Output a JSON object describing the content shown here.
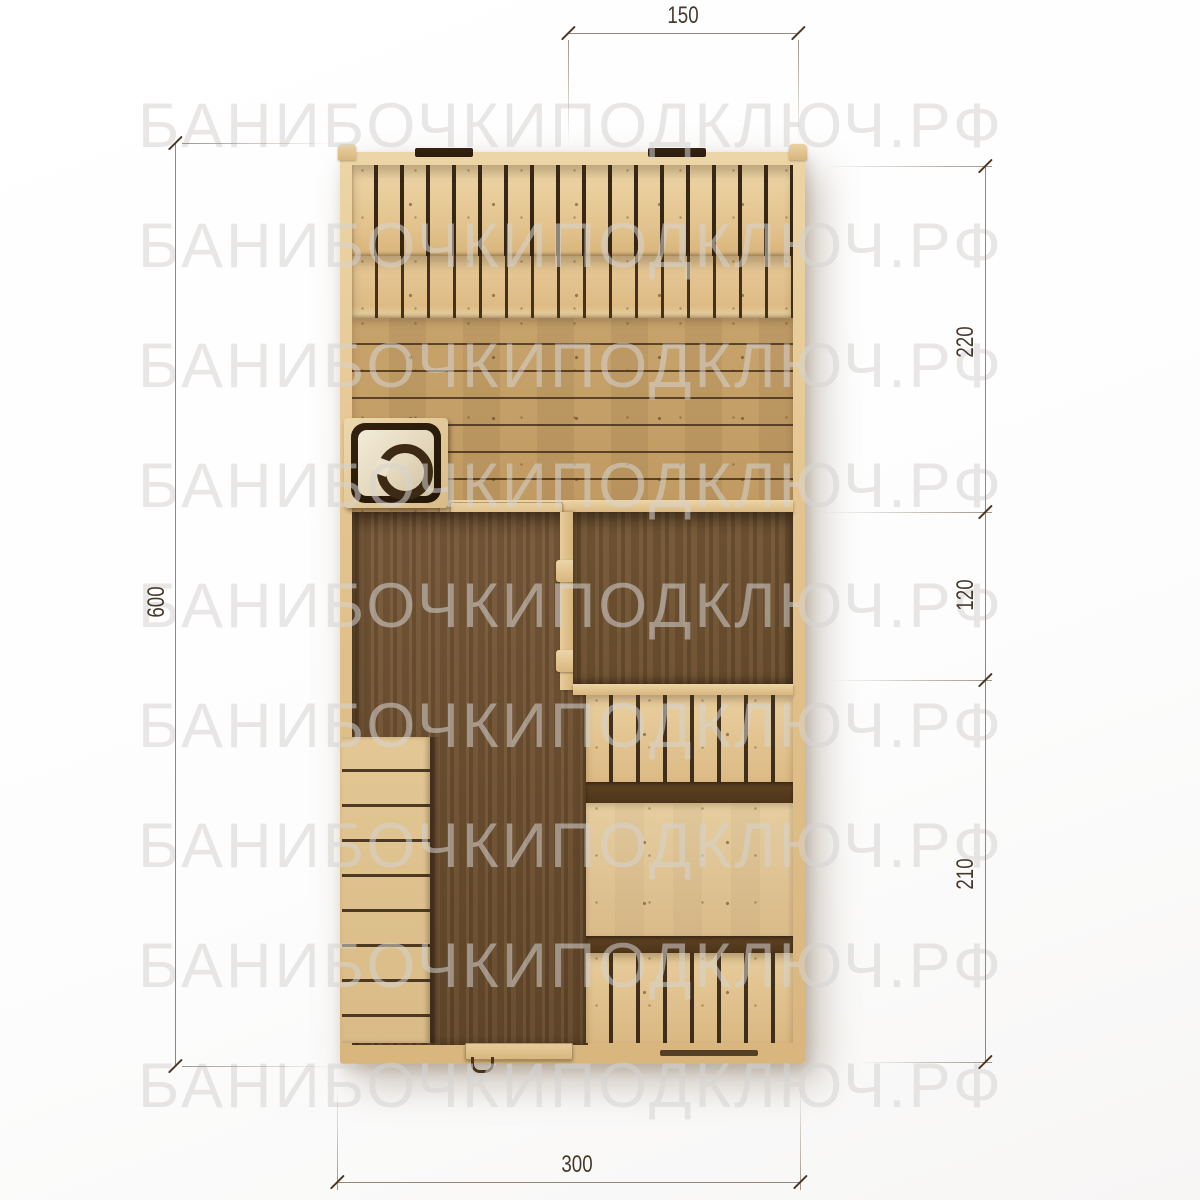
{
  "watermark": {
    "text": "БАНИБОЧКИПОДКЛЮЧ.РФ"
  },
  "dimensions": {
    "top": "150",
    "right_upper": "220",
    "right_middle": "120",
    "right_lower": "210",
    "left": "600",
    "bottom": "300"
  },
  "plan_parts": {
    "stove": "stove-top-view",
    "steam_room_upper_bench": "vertical-slat-bench",
    "steam_room_lower_bench": "vertical-slat-bench",
    "steam_room_floor": "horizontal-plank-floor",
    "washing_room_floor": "dark-wood-floor",
    "lounge_room_floor": "dark-wood-floor",
    "lounge_bench_top": "vertical-slat-bench",
    "lounge_table": "wood-table",
    "lounge_bench_bottom": "vertical-slat-bench",
    "entrance_steps": "stairs",
    "roof_vents": "vent-bar"
  },
  "colors": {
    "wood_light": "#e2c28d",
    "wood_gap": "#2e1f10",
    "floor_dark": "#6c4f30",
    "dim_line": "#93867a",
    "dim_text": "#463a2b",
    "watermark": "#ececec"
  }
}
